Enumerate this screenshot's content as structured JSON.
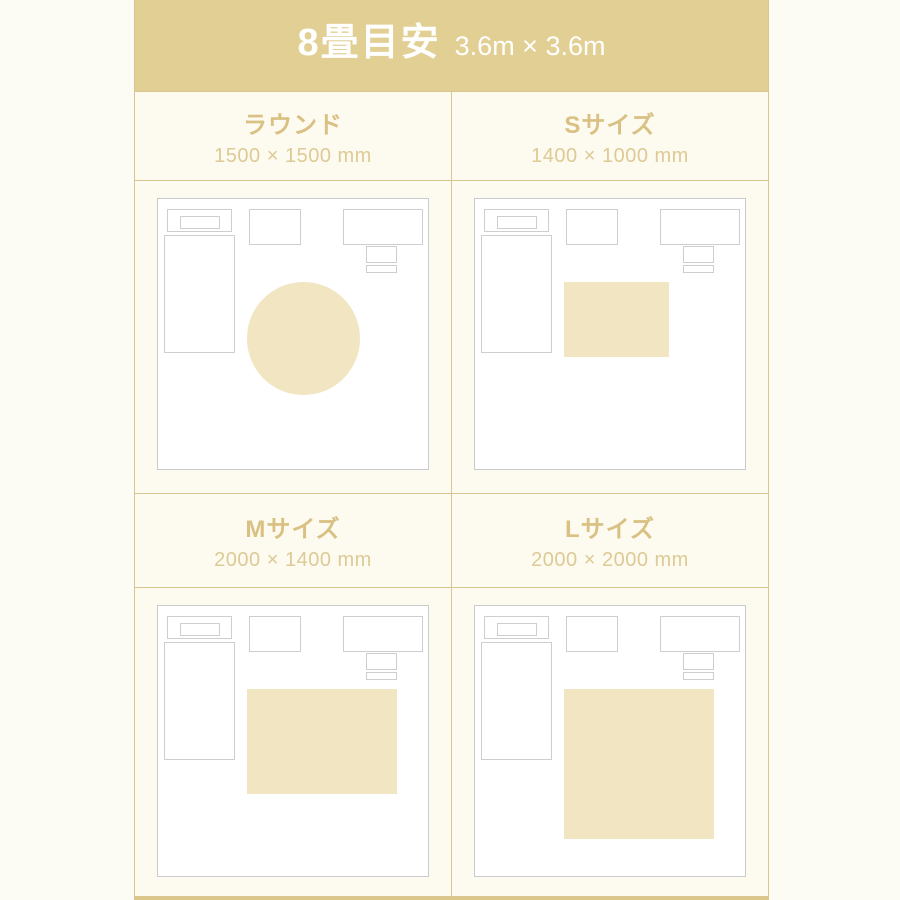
{
  "header": {
    "title": "8畳目安",
    "subtitle": "3.6m × 3.6m"
  },
  "room": {
    "room_mm": 3600,
    "rug_anchor": {
      "left_pct": 33.0,
      "top_pct": 30.8
    },
    "furniture": [
      {
        "name": "bed-headboard-outline",
        "left_pct": 3.3,
        "top_pct": 3.6,
        "width_pct": 24.0,
        "height_pct": 8.5
      },
      {
        "name": "bed-pillow-outline",
        "left_pct": 8.1,
        "top_pct": 6.4,
        "width_pct": 15.0,
        "height_pct": 4.8
      },
      {
        "name": "bed-body-outline",
        "left_pct": 2.2,
        "top_pct": 13.2,
        "width_pct": 26.2,
        "height_pct": 43.8
      },
      {
        "name": "side-table-outline",
        "left_pct": 33.8,
        "top_pct": 3.6,
        "width_pct": 19.0,
        "height_pct": 13.4
      },
      {
        "name": "desk-outline",
        "left_pct": 68.6,
        "top_pct": 3.6,
        "width_pct": 29.4,
        "height_pct": 13.4
      },
      {
        "name": "chair-back-outline",
        "left_pct": 77.2,
        "top_pct": 17.3,
        "width_pct": 11.4,
        "height_pct": 6.3
      },
      {
        "name": "chair-seat-outline",
        "left_pct": 77.2,
        "top_pct": 24.4,
        "width_pct": 11.4,
        "height_pct": 2.9
      }
    ]
  },
  "panels": [
    {
      "title": "ラウンド",
      "dimensions": "1500 × 1500 mm",
      "rug": {
        "shape": "circle",
        "w_mm": 1500,
        "h_mm": 1500
      }
    },
    {
      "title": "Sサイズ",
      "dimensions": "1400 × 1000 mm",
      "rug": {
        "shape": "rect",
        "w_mm": 1400,
        "h_mm": 1000
      }
    },
    {
      "title": "Mサイズ",
      "dimensions": "2000 × 1400 mm",
      "rug": {
        "shape": "rect",
        "w_mm": 2000,
        "h_mm": 1400
      }
    },
    {
      "title": "Lサイズ",
      "dimensions": "2000 × 2000 mm",
      "rug": {
        "shape": "rect",
        "w_mm": 2000,
        "h_mm": 2000
      }
    }
  ],
  "colors": {
    "page_background": "#fdfcf4",
    "header_background": "#e2cf93",
    "header_text": "#ffffff",
    "grid_line_gold": "#d8c692",
    "panel_background": "#fdfaef",
    "panel_title_text": "#d9c183",
    "panel_dims_text": "#ddca96",
    "room_border_gray": "#c9cbcd",
    "rug_fill": "#f2e5c1",
    "bottom_bar": "#dcc688"
  }
}
